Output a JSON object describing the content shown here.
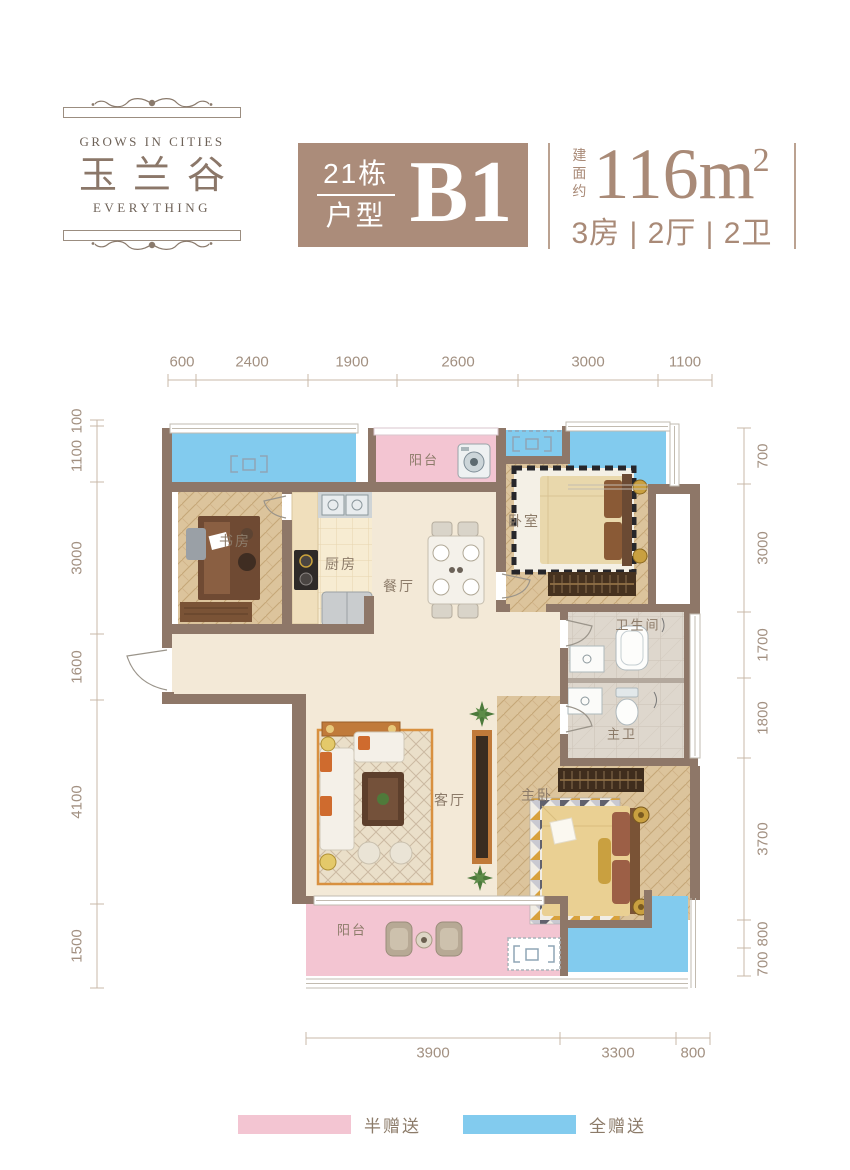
{
  "brand": {
    "tagline_top": "GROWS IN CITIES",
    "name": "玉兰谷",
    "tagline_bottom": "EVERYTHING"
  },
  "unit_card": {
    "building": "21栋",
    "label": "户型",
    "code": "B1"
  },
  "area_card": {
    "prefix": "建面约",
    "value": "116m",
    "sup": "2",
    "layout": "3房 | 2厅 | 2卫"
  },
  "plan": {
    "rooms": [
      {
        "id": "balcony-top",
        "label": "阳台"
      },
      {
        "id": "study",
        "label": "书房"
      },
      {
        "id": "kitchen",
        "label": "厨房"
      },
      {
        "id": "dining",
        "label": "餐厅"
      },
      {
        "id": "bedroom",
        "label": "卧室"
      },
      {
        "id": "bathroom",
        "label": "卫生间"
      },
      {
        "id": "master-bath",
        "label": "主卫"
      },
      {
        "id": "living",
        "label": "客厅"
      },
      {
        "id": "master-bedroom",
        "label": "主卧"
      },
      {
        "id": "balcony-bottom",
        "label": "阳台"
      }
    ],
    "dims": {
      "top": [
        "600",
        "2400",
        "1900",
        "2600",
        "3000",
        "1100"
      ],
      "left": [
        "100",
        "1100",
        "3000",
        "1600",
        "4100",
        "1500"
      ],
      "right": [
        "700",
        "3000",
        "1700",
        "1800",
        "3700",
        "800",
        "700"
      ],
      "bottom": [
        "3900",
        "3300",
        "800"
      ]
    },
    "ac_symbol": "AC"
  },
  "legend": {
    "items": [
      {
        "id": "half-gift",
        "label": "半赠送",
        "color": "#f3c5d2"
      },
      {
        "id": "full-gift",
        "label": "全赠送",
        "color": "#82cbee"
      }
    ]
  },
  "colors": {
    "wall": "#8e7768",
    "accent_brown": "#ab8c7a",
    "text_brown": "#a98a77",
    "balcony_pink": "#f3c5d2",
    "balcony_blue": "#82cbee",
    "floor_cream": "#f3e9d7",
    "floor_wood": "#dcc49c",
    "dim_text": "#a29081"
  }
}
